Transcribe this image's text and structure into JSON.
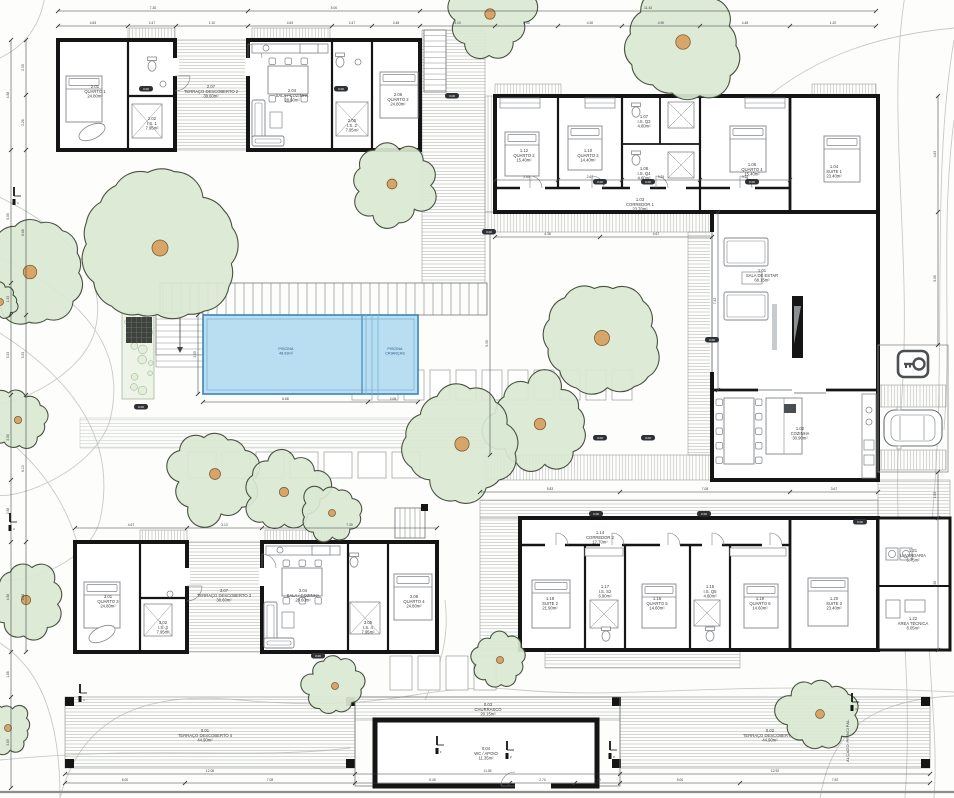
{
  "document": {
    "type": "architectural-site-plan",
    "bottom_right_note": "ALÇADO PRINCIPAL"
  },
  "colors": {
    "wall": "#151515",
    "pool_fill": "#b9def2",
    "pool_edge": "#3a85b5",
    "pool_inner": "#79b6d8",
    "tree_fill": "#d9e8d2",
    "tree_edge": "#47523e",
    "trunk": "#d9a468",
    "hatch": "#a9ada9",
    "contour": "#c9c9c4",
    "furniture": "#82878c",
    "dim": "#3a3d40",
    "garden": "#edf3e7"
  },
  "pool": {
    "main": {
      "name": "PISCINA",
      "area": "48.93m²"
    },
    "kids": {
      "name": "PISCINA",
      "area": "CRIANÇAS"
    }
  },
  "rooms": {
    "sA_bed": {
      "num": "2.01",
      "name": "QUARTO 1",
      "area": "24.80m²"
    },
    "sA_is": {
      "num": "2.02",
      "name": "I.S. 1",
      "area": "7.95m²"
    },
    "sB_sala": {
      "num": "2.04",
      "name": "SALA / COZINHA",
      "area": "28.60m²"
    },
    "sB_is": {
      "num": "2.05",
      "name": "I.S. 2",
      "area": "7.95m²"
    },
    "sB_bed": {
      "num": "2.06",
      "name": "QUARTO 2",
      "area": "24.80m²"
    },
    "deck_gap_top": {
      "num": "2.07",
      "name": "TERRAÇO DESCOBERTO 2",
      "area": "38.60m²"
    },
    "corridorE": {
      "num": "1.03",
      "name": "CORREDOR 1",
      "area": "23.70m²"
    },
    "e_bed1": {
      "num": "1.12",
      "name": "QUARTO 2",
      "area": "15.40m²"
    },
    "e_bed2": {
      "num": "1.10",
      "name": "QUARTO 3",
      "area": "14.40m²"
    },
    "e_is1": {
      "num": "1.07",
      "name": "I.S. Q3",
      "area": "4.60m²"
    },
    "e_is2": {
      "num": "1.08",
      "name": "I.S. Q4",
      "area": "4.60m²"
    },
    "e_bed3": {
      "num": "1.06",
      "name": "QUARTO 4",
      "area": "15.40m²"
    },
    "e_suite": {
      "num": "1.04",
      "name": "SUITE 1",
      "area": "23.40m²"
    },
    "living": {
      "num": "1.01",
      "name": "SALA DE ESTAR",
      "area": "68.15m²"
    },
    "kitchen": {
      "num": "1.02",
      "name": "COZINHA",
      "area": "30.90m²"
    },
    "h_corridor": {
      "num": "1.14",
      "name": "CORREDOR 2",
      "area": "17.70m²"
    },
    "h_bed1": {
      "num": "1.18",
      "name": "SUITE 2",
      "area": "21.90m²"
    },
    "h_is1": {
      "num": "1.17",
      "name": "I.S. S2",
      "area": "6.90m²"
    },
    "h_bed2": {
      "num": "1.16",
      "name": "QUARTO 5",
      "area": "14.60m²"
    },
    "h_is2": {
      "num": "1.15",
      "name": "I.S. Q5",
      "area": "4.60m²"
    },
    "h_bed3": {
      "num": "1.19",
      "name": "QUARTO 6",
      "area": "14.60m²"
    },
    "h_suite": {
      "num": "1.20",
      "name": "SUITE 3",
      "area": "23.40m²"
    },
    "laundry": {
      "num": "1.21",
      "name": "LAVANDARIA",
      "area": "5.75m²"
    },
    "tech": {
      "num": "1.22",
      "name": "ÁREA TÉCNICA",
      "area": "8.05m²"
    },
    "sC_bed": {
      "num": "3.01",
      "name": "QUARTO 3",
      "area": "24.80m²"
    },
    "sC_is": {
      "num": "3.02",
      "name": "I.S. 3",
      "area": "7.95m²"
    },
    "sD_sala": {
      "num": "3.04",
      "name": "SALA / COZINHA",
      "area": "28.60m²"
    },
    "sD_is": {
      "num": "3.05",
      "name": "I.S. 4",
      "area": "7.95m²"
    },
    "sD_bed": {
      "num": "3.06",
      "name": "QUARTO 4",
      "area": "24.80m²"
    },
    "deck_gap_bottom": {
      "num": "3.07",
      "name": "TERRAÇO DESCOBERTO 3",
      "area": "38.60m²"
    },
    "terrace_left": {
      "num": "0.01",
      "name": "TERRAÇO DESCOBERTO 4",
      "area": "44.90m²"
    },
    "churrasco": {
      "num": "0.03",
      "name": "CHURRASCO",
      "area": "20.15m²"
    },
    "apoio": {
      "num": "0.04",
      "name": "WC / APOIO",
      "area": "11.35m²"
    },
    "terrace_right": {
      "num": "0.02",
      "name": "TERRAÇO DESCOBERTO 5",
      "area": "44.90m²"
    }
  },
  "dims": {
    "top1": [
      "7.30",
      "5.00",
      "11.43"
    ],
    "top2": [
      "4.63",
      "2.47",
      "1.10",
      "4.63",
      "2.47",
      "3.48",
      "4.10",
      "3.50",
      "4.30",
      "4.90",
      "4.48",
      "1.20"
    ],
    "left1": [
      "4.58",
      "5.55",
      "1.33",
      "3.33",
      "3.55",
      "2.58",
      "4.58",
      "1.88",
      "3.80"
    ],
    "left2": [
      "2.30",
      "2.28",
      "6.88",
      "3.33",
      "6.13",
      "4.58"
    ],
    "bottom1": [
      "12.08",
      "11.05",
      "12.92"
    ],
    "bottom2": [
      "5.00",
      "7.08",
      "6.45",
      "2.70",
      "1.88",
      "5.00",
      "7.92"
    ],
    "right1": [
      "4.83",
      "5.55"
    ],
    "right2": [
      "1.92",
      "5.50"
    ],
    "pool_b": [
      "6.88",
      "2.08"
    ],
    "pool_l": [
      "3.30"
    ],
    "court1": [
      "4.38",
      "4.67"
    ],
    "court_l": [
      "9.30"
    ],
    "mid1": [
      "5.83",
      "7.08",
      "3.67"
    ],
    "blw_top": [
      "4.67",
      "3.13",
      "7.30"
    ],
    "living_l": [
      "7.42"
    ],
    "e_int": [
      "2.63",
      "2.67",
      "3.25",
      "3.75"
    ]
  },
  "elevation_marker": "0.00",
  "section_markers": [
    "1",
    "2",
    "3",
    "1'",
    "2'",
    "3'",
    "4"
  ],
  "icons": {
    "parking": "key-icon",
    "stairs_arrow": "arrow-down-icon"
  }
}
